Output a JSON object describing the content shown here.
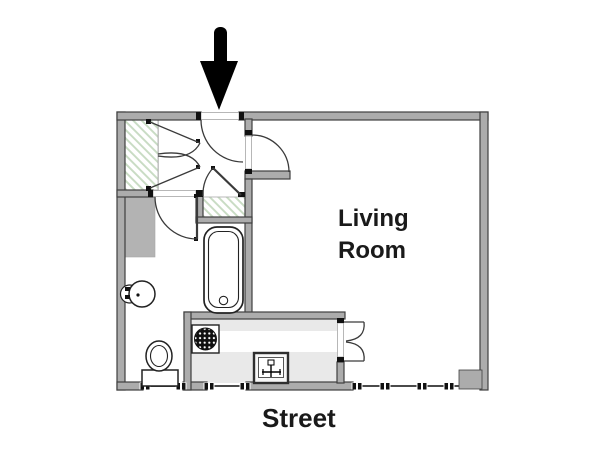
{
  "page": {
    "type": "apartment-floor-plan",
    "background": "#ffffff"
  },
  "labels": {
    "living_room": "Living Room",
    "living_room_line1": "Living",
    "living_room_line2": "Room",
    "street": "Street"
  },
  "icons": {
    "entrance-arrow": "solid black downward arrow marking the apartment entrance",
    "door-swing": "quarter-circle door swing arc",
    "bifold-door": "folding closet/pass-through door symbol",
    "closet-hatch": "green diagonal hatching marking closet floor",
    "bathtub": "bathtub seen from above",
    "bathroom-sink": "round pedestal washbasin",
    "toilet": "toilet bowl with tank",
    "stove": "cooktop burner drawn as dotted circle",
    "kitchen-sink": "kitchen sink square with faucet",
    "window-marker": "small black window mullion markers along the street wall",
    "duct": "solid grey service shaft",
    "corner-pillar": "solid grey pillar in lower-right corner"
  },
  "colors": {
    "wall_fill": "#acacac",
    "wall_outline": "#3f3f3f",
    "closet_hatch": "#c9dcc4",
    "counter": "#e9e9e9",
    "duct_fill": "#b3b3b3",
    "arrow": "#000000",
    "text": "#1a1a1a"
  }
}
